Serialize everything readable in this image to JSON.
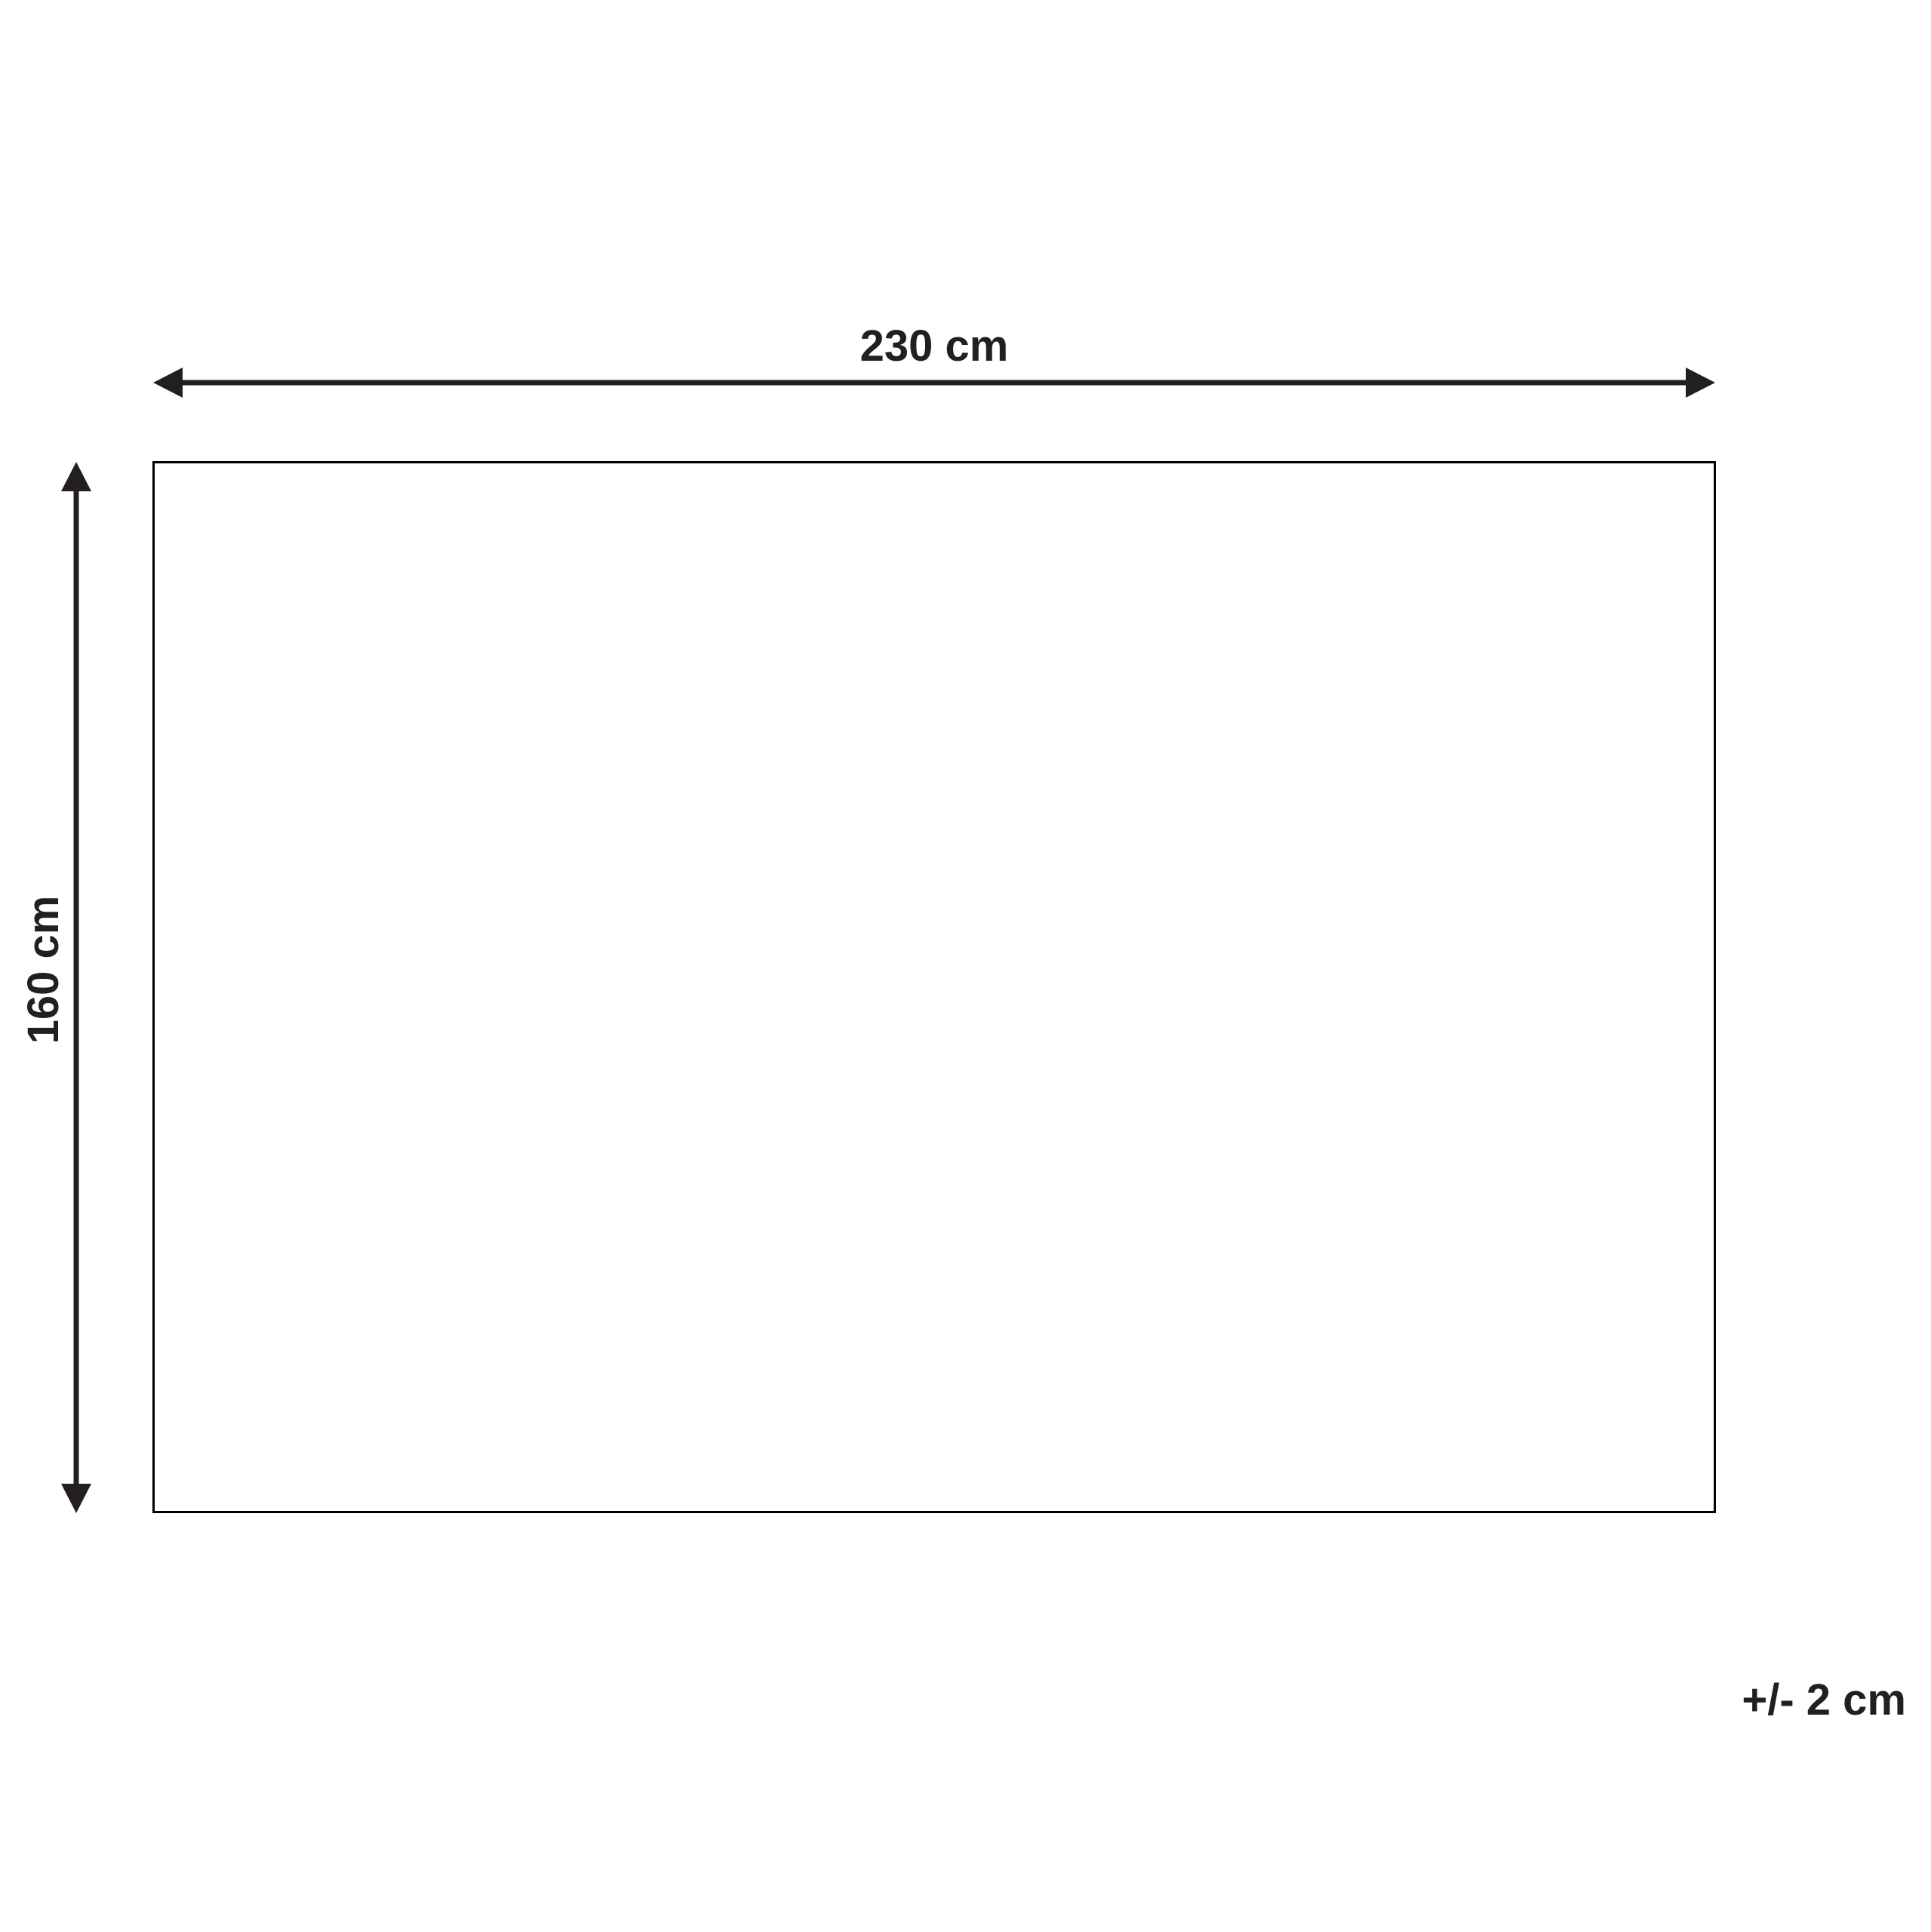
{
  "diagram": {
    "type": "product-dimension-diagram",
    "shape": "rectangle",
    "width_label": "230 cm",
    "height_label": "160 cm",
    "tolerance_label": "+/- 2 cm",
    "width_value_cm": 230,
    "height_value_cm": 160,
    "tolerance_value_cm": 2
  },
  "colors": {
    "ink": "#231f20",
    "outline": "#000000",
    "background": "#ffffff"
  }
}
